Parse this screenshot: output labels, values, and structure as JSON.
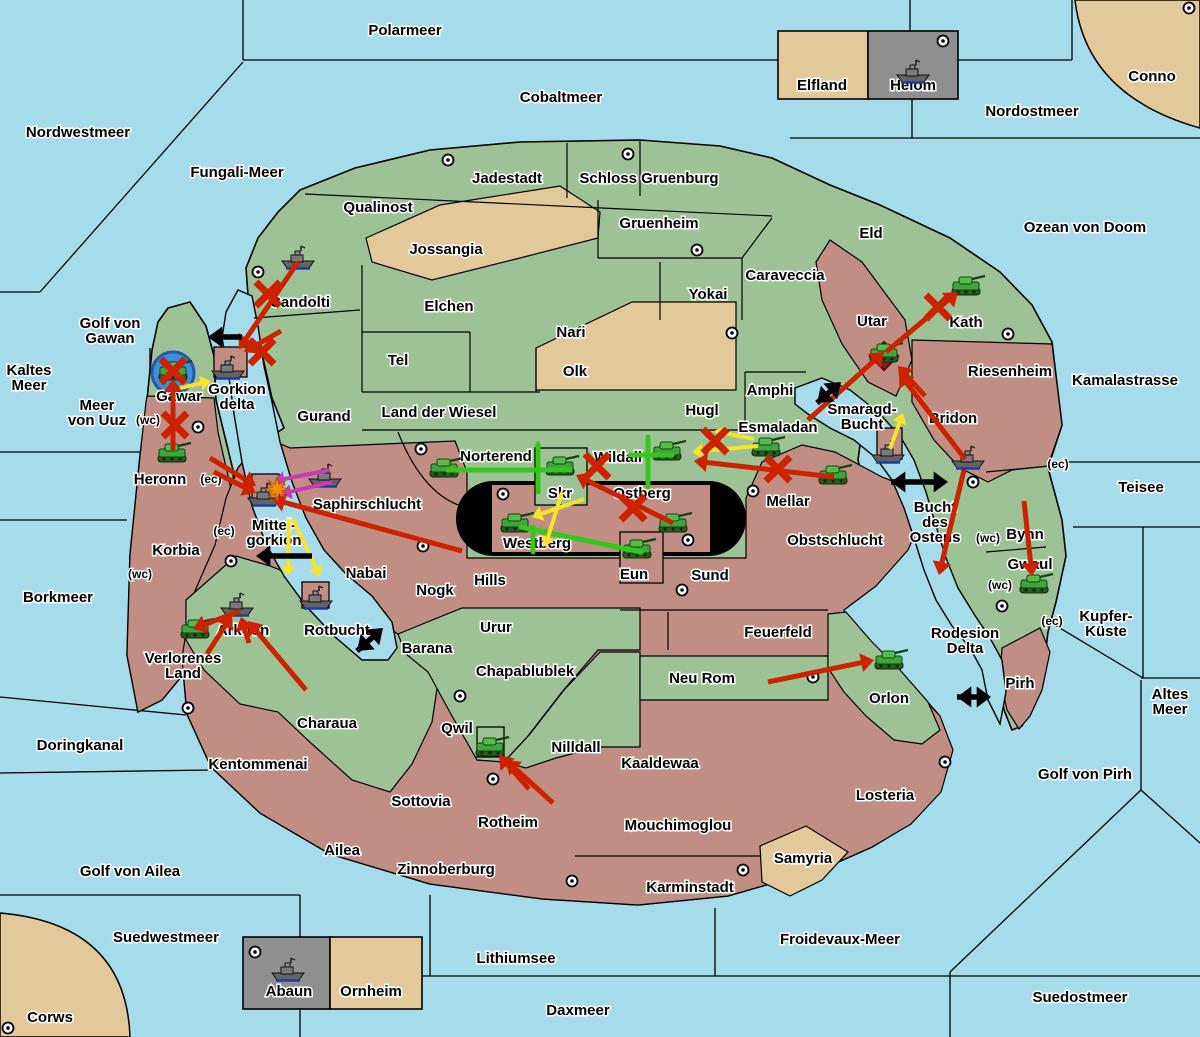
{
  "map_title": "Fantasy strategy game map",
  "colors": {
    "sea": "#A6DBEB",
    "land_green": "#9DC295",
    "land_rose": "#C18E84",
    "land_tan": "#E3C89B",
    "panel_gray": "#8F8F8F",
    "border": "#000000",
    "arrow_red": "#CC2200",
    "arrow_yellow": "#F5E32E",
    "arrow_green": "#35C71B",
    "arrow_purple": "#C93BB4",
    "arrow_black": "#000000",
    "roundel_blue": "#3E8EDC",
    "diamond_dark_red": "#8B1A1A",
    "burst_orange": "#FF8C00"
  },
  "sea_labels": [
    {
      "text": "Polarmeer",
      "x": 405,
      "y": 35
    },
    {
      "text": "Cobaltmeer",
      "x": 561,
      "y": 102
    },
    {
      "text": "Nordostmeer",
      "x": 1032,
      "y": 116
    },
    {
      "text": "Conno",
      "x": 1152,
      "y": 81
    },
    {
      "text": "Nordwestmeer",
      "x": 78,
      "y": 137
    },
    {
      "text": "Fungali-Meer",
      "x": 237,
      "y": 177
    },
    {
      "text": "Ozean von Doom",
      "x": 1085,
      "y": 232
    },
    {
      "text": "Golf von\nGawan",
      "x": 110,
      "y": 328
    },
    {
      "text": "Kaltes\nMeer",
      "x": 29,
      "y": 375
    },
    {
      "text": "Meer\nvon Uuz",
      "x": 97,
      "y": 410
    },
    {
      "text": "Kamalastrasse",
      "x": 1125,
      "y": 385
    },
    {
      "text": "Teisee",
      "x": 1141,
      "y": 492
    },
    {
      "text": "Kupfer-\nKüste",
      "x": 1106,
      "y": 621
    },
    {
      "text": "Borkmeer",
      "x": 58,
      "y": 602
    },
    {
      "text": "Doringkanal",
      "x": 80,
      "y": 750
    },
    {
      "text": "Golf von Ailea",
      "x": 130,
      "y": 876
    },
    {
      "text": "Suedwestmeer",
      "x": 166,
      "y": 942
    },
    {
      "text": "Corws",
      "x": 50,
      "y": 1022
    },
    {
      "text": "Lithiumsee",
      "x": 516,
      "y": 963
    },
    {
      "text": "Daxmeer",
      "x": 578,
      "y": 1015
    },
    {
      "text": "Froidevaux-Meer",
      "x": 840,
      "y": 944
    },
    {
      "text": "Suedostmeer",
      "x": 1080,
      "y": 1002
    },
    {
      "text": "Golf von Pirh",
      "x": 1085,
      "y": 779
    },
    {
      "text": "Altes\nMeer",
      "x": 1170,
      "y": 699
    },
    {
      "text": "Bucht\ndes\nOstens",
      "x": 935,
      "y": 512
    },
    {
      "text": "Smaragd-\nBucht",
      "x": 862,
      "y": 414
    },
    {
      "text": "Rodesion\nDelta",
      "x": 965,
      "y": 638
    },
    {
      "text": "Rotbucht",
      "x": 337,
      "y": 635
    }
  ],
  "land_labels": [
    {
      "text": "Jadestadt",
      "x": 507,
      "y": 183
    },
    {
      "text": "Schloss Gruenburg",
      "x": 649,
      "y": 183
    },
    {
      "text": "Qualinost",
      "x": 378,
      "y": 212
    },
    {
      "text": "Jossangia",
      "x": 446,
      "y": 254
    },
    {
      "text": "Gruenheim",
      "x": 659,
      "y": 228
    },
    {
      "text": "Caraveccia",
      "x": 785,
      "y": 280
    },
    {
      "text": "Eld",
      "x": 871,
      "y": 238
    },
    {
      "text": "Elchen",
      "x": 449,
      "y": 311
    },
    {
      "text": "Yokai",
      "x": 708,
      "y": 299
    },
    {
      "text": "Nari",
      "x": 571,
      "y": 337
    },
    {
      "text": "Tel",
      "x": 398,
      "y": 365
    },
    {
      "text": "Olk",
      "x": 575,
      "y": 376
    },
    {
      "text": "Candolti",
      "x": 300,
      "y": 307
    },
    {
      "text": "Utar",
      "x": 872,
      "y": 326
    },
    {
      "text": "Kath",
      "x": 966,
      "y": 327
    },
    {
      "text": "Riesenheim",
      "x": 1010,
      "y": 376
    },
    {
      "text": "Gurand",
      "x": 324,
      "y": 421
    },
    {
      "text": "Land der Wiesel",
      "x": 439,
      "y": 417
    },
    {
      "text": "Hugl",
      "x": 702,
      "y": 415
    },
    {
      "text": "Amphi",
      "x": 770,
      "y": 395
    },
    {
      "text": "Esmaladan",
      "x": 778,
      "y": 432
    },
    {
      "text": "Bridon",
      "x": 953,
      "y": 423
    },
    {
      "text": "Gawar",
      "x": 179,
      "y": 401
    },
    {
      "text": "Gorkion\ndelta",
      "x": 237,
      "y": 394
    },
    {
      "text": "Heronn",
      "x": 160,
      "y": 484
    },
    {
      "text": "Korbia",
      "x": 176,
      "y": 555
    },
    {
      "text": "Mittel-\ngorkion",
      "x": 274,
      "y": 530
    },
    {
      "text": "Saphirschlucht",
      "x": 367,
      "y": 509
    },
    {
      "text": "Norterend",
      "x": 496,
      "y": 461
    },
    {
      "text": "Wildall",
      "x": 618,
      "y": 462
    },
    {
      "text": "Skr",
      "x": 560,
      "y": 498
    },
    {
      "text": "Ostberg",
      "x": 642,
      "y": 498
    },
    {
      "text": "Mellar",
      "x": 788,
      "y": 506
    },
    {
      "text": "Westberg",
      "x": 537,
      "y": 548
    },
    {
      "text": "Eun",
      "x": 634,
      "y": 579
    },
    {
      "text": "Sund",
      "x": 710,
      "y": 580
    },
    {
      "text": "Obstschlucht",
      "x": 835,
      "y": 545
    },
    {
      "text": "Nabai",
      "x": 366,
      "y": 578
    },
    {
      "text": "Nogk",
      "x": 435,
      "y": 595
    },
    {
      "text": "Hills",
      "x": 490,
      "y": 585
    },
    {
      "text": "Bynn",
      "x": 1025,
      "y": 539
    },
    {
      "text": "Gwaul",
      "x": 1030,
      "y": 569
    },
    {
      "text": "Arkoon",
      "x": 243,
      "y": 635
    },
    {
      "text": "Verlorenes\nLand",
      "x": 183,
      "y": 663
    },
    {
      "text": "Barana",
      "x": 427,
      "y": 653
    },
    {
      "text": "Urur",
      "x": 496,
      "y": 632
    },
    {
      "text": "Feuerfeld",
      "x": 778,
      "y": 637
    },
    {
      "text": "Chapablublek",
      "x": 525,
      "y": 676
    },
    {
      "text": "Neu Rom",
      "x": 702,
      "y": 683
    },
    {
      "text": "Orlon",
      "x": 889,
      "y": 703
    },
    {
      "text": "Pirh",
      "x": 1020,
      "y": 688
    },
    {
      "text": "Charaua",
      "x": 327,
      "y": 728
    },
    {
      "text": "Qwil",
      "x": 457,
      "y": 733
    },
    {
      "text": "Nilldall",
      "x": 576,
      "y": 752
    },
    {
      "text": "Kaaldewaa",
      "x": 660,
      "y": 768
    },
    {
      "text": "Kentommenai",
      "x": 258,
      "y": 769
    },
    {
      "text": "Losteria",
      "x": 885,
      "y": 800
    },
    {
      "text": "Sottovia",
      "x": 421,
      "y": 806
    },
    {
      "text": "Rotheim",
      "x": 508,
      "y": 827
    },
    {
      "text": "Mouchimoglou",
      "x": 678,
      "y": 830
    },
    {
      "text": "Ailea",
      "x": 342,
      "y": 855
    },
    {
      "text": "Zinnoberburg",
      "x": 446,
      "y": 874
    },
    {
      "text": "Karminstadt",
      "x": 690,
      "y": 892
    },
    {
      "text": "Samyria",
      "x": 803,
      "y": 863
    }
  ],
  "coast_labels": [
    {
      "text": "(wc)",
      "x": 148,
      "y": 424
    },
    {
      "text": "(ec)",
      "x": 211,
      "y": 483
    },
    {
      "text": "(ec)",
      "x": 224,
      "y": 535
    },
    {
      "text": "(wc)",
      "x": 140,
      "y": 578
    },
    {
      "text": "(ec)",
      "x": 1058,
      "y": 468
    },
    {
      "text": "(wc)",
      "x": 988,
      "y": 542
    },
    {
      "text": "(wc)",
      "x": 1000,
      "y": 589
    },
    {
      "text": "(ec)",
      "x": 1052,
      "y": 625
    }
  ],
  "panels": [
    {
      "name": "elfland",
      "label": "Elfland",
      "x": 822,
      "y": 90,
      "fill": "tan"
    },
    {
      "name": "helom",
      "label": "Helom",
      "x": 913,
      "y": 90,
      "fill": "gray",
      "has_ship": true,
      "has_dot": true
    },
    {
      "name": "abaun",
      "label": "Abaun",
      "x": 289,
      "y": 996,
      "fill": "gray",
      "has_ship": true,
      "has_dot": true
    },
    {
      "name": "ornheim",
      "label": "Ornheim",
      "x": 371,
      "y": 996,
      "fill": "tan"
    }
  ],
  "supply_centers": [
    [
      448,
      160
    ],
    [
      628,
      154
    ],
    [
      697,
      250
    ],
    [
      732,
      333
    ],
    [
      1189,
      8
    ],
    [
      943,
      41
    ],
    [
      258,
      272
    ],
    [
      198,
      427
    ],
    [
      421,
      449
    ],
    [
      423,
      546
    ],
    [
      503,
      494
    ],
    [
      688,
      540
    ],
    [
      753,
      491
    ],
    [
      682,
      590
    ],
    [
      1008,
      334
    ],
    [
      973,
      482
    ],
    [
      1002,
      606
    ],
    [
      231,
      561
    ],
    [
      188,
      708
    ],
    [
      460,
      696
    ],
    [
      493,
      779
    ],
    [
      813,
      677
    ],
    [
      945,
      762
    ],
    [
      743,
      870
    ],
    [
      572,
      881
    ],
    [
      255,
      952
    ],
    [
      8,
      1028
    ]
  ],
  "units": {
    "tanks": [
      [
        173,
        372
      ],
      [
        172,
        454
      ],
      [
        195,
        630
      ],
      [
        444,
        469
      ],
      [
        560,
        467
      ],
      [
        515,
        524
      ],
      [
        637,
        550
      ],
      [
        673,
        524
      ],
      [
        667,
        452
      ],
      [
        766,
        448
      ],
      [
        833,
        476
      ],
      [
        966,
        287
      ],
      [
        884,
        354
      ],
      [
        1034,
        585
      ],
      [
        889,
        661
      ],
      [
        490,
        748
      ]
    ],
    "ships": [
      [
        298,
        259
      ],
      [
        228,
        369
      ],
      [
        913,
        73
      ],
      [
        325,
        477
      ],
      [
        264,
        496
      ],
      [
        316,
        599
      ],
      [
        237,
        606
      ],
      [
        888,
        453
      ],
      [
        968,
        459
      ],
      [
        288,
        971
      ]
    ]
  },
  "arrows": {
    "red": [
      [
        298,
        262,
        239,
        349
      ],
      [
        281,
        331,
        244,
        352
      ],
      [
        173,
        450,
        173,
        379
      ],
      [
        210,
        458,
        256,
        486
      ],
      [
        214,
        472,
        256,
        493
      ],
      [
        462,
        551,
        272,
        499
      ],
      [
        240,
        611,
        193,
        629
      ],
      [
        207,
        654,
        232,
        615
      ],
      [
        249,
        643,
        241,
        617
      ],
      [
        306,
        690,
        248,
        621
      ],
      [
        834,
        477,
        694,
        461
      ],
      [
        673,
        523,
        576,
        475
      ],
      [
        808,
        420,
        884,
        352
      ],
      [
        886,
        352,
        958,
        292
      ],
      [
        965,
        459,
        899,
        373
      ],
      [
        925,
        396,
        898,
        366
      ],
      [
        964,
        470,
        939,
        575
      ],
      [
        1024,
        501,
        1032,
        576
      ],
      [
        768,
        682,
        874,
        660
      ],
      [
        553,
        803,
        506,
        760
      ],
      [
        529,
        789,
        499,
        755
      ]
    ],
    "yellow": [
      [
        180,
        388,
        211,
        381
      ],
      [
        289,
        519,
        288,
        576
      ],
      [
        293,
        519,
        320,
        577
      ],
      [
        758,
        446,
        692,
        452
      ],
      [
        754,
        439,
        714,
        431
      ],
      [
        890,
        449,
        903,
        413
      ],
      [
        584,
        499,
        532,
        517
      ],
      [
        562,
        492,
        545,
        547
      ]
    ],
    "green_lines": [
      [
        448,
        470,
        570,
        470
      ],
      [
        538,
        444,
        538,
        492
      ],
      [
        648,
        437,
        648,
        487
      ],
      [
        630,
        455,
        672,
        455
      ],
      [
        521,
        527,
        641,
        552
      ],
      [
        533,
        527,
        533,
        552
      ]
    ],
    "purple": [
      [
        330,
        470,
        274,
        481
      ],
      [
        332,
        482,
        281,
        494
      ]
    ],
    "black_single": [
      [
        242,
        337,
        208,
        337
      ],
      [
        312,
        556,
        256,
        556
      ]
    ],
    "black_double": [
      [
        357,
        651,
        383,
        628
      ],
      [
        817,
        403,
        841,
        382
      ],
      [
        891,
        482,
        948,
        482
      ],
      [
        957,
        697,
        991,
        697
      ]
    ]
  },
  "x_marks": [
    [
      268,
      294
    ],
    [
      262,
      352
    ],
    [
      175,
      425
    ],
    [
      173,
      371
    ],
    [
      938,
      307
    ],
    [
      715,
      441
    ],
    [
      778,
      469
    ],
    [
      633,
      508
    ],
    [
      597,
      466
    ]
  ],
  "markers": {
    "roundel": [
      173,
      373
    ],
    "diamond": [
      884,
      356
    ],
    "burst": [
      277,
      489
    ]
  }
}
